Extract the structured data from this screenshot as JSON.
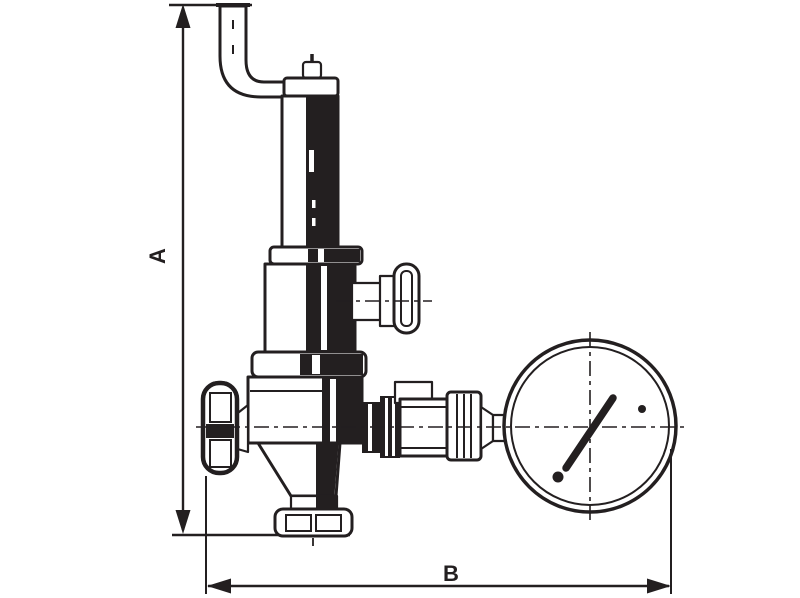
{
  "diagram": {
    "kind": "technical-dimension-drawing",
    "subject": "pressure-reducing-valve-with-pressure-gauge",
    "ink_color": "#231f20",
    "background_color": "#ffffff",
    "dimension_labels": {
      "height": "A",
      "width": "B"
    },
    "parts": [
      "discharge-elbow-pipe",
      "adjustment-bonnet",
      "spring-chamber",
      "tee-handle",
      "handwheel",
      "valve-body",
      "bottom-union-fitting",
      "outlet-coupling",
      "pressure-gauge"
    ]
  }
}
